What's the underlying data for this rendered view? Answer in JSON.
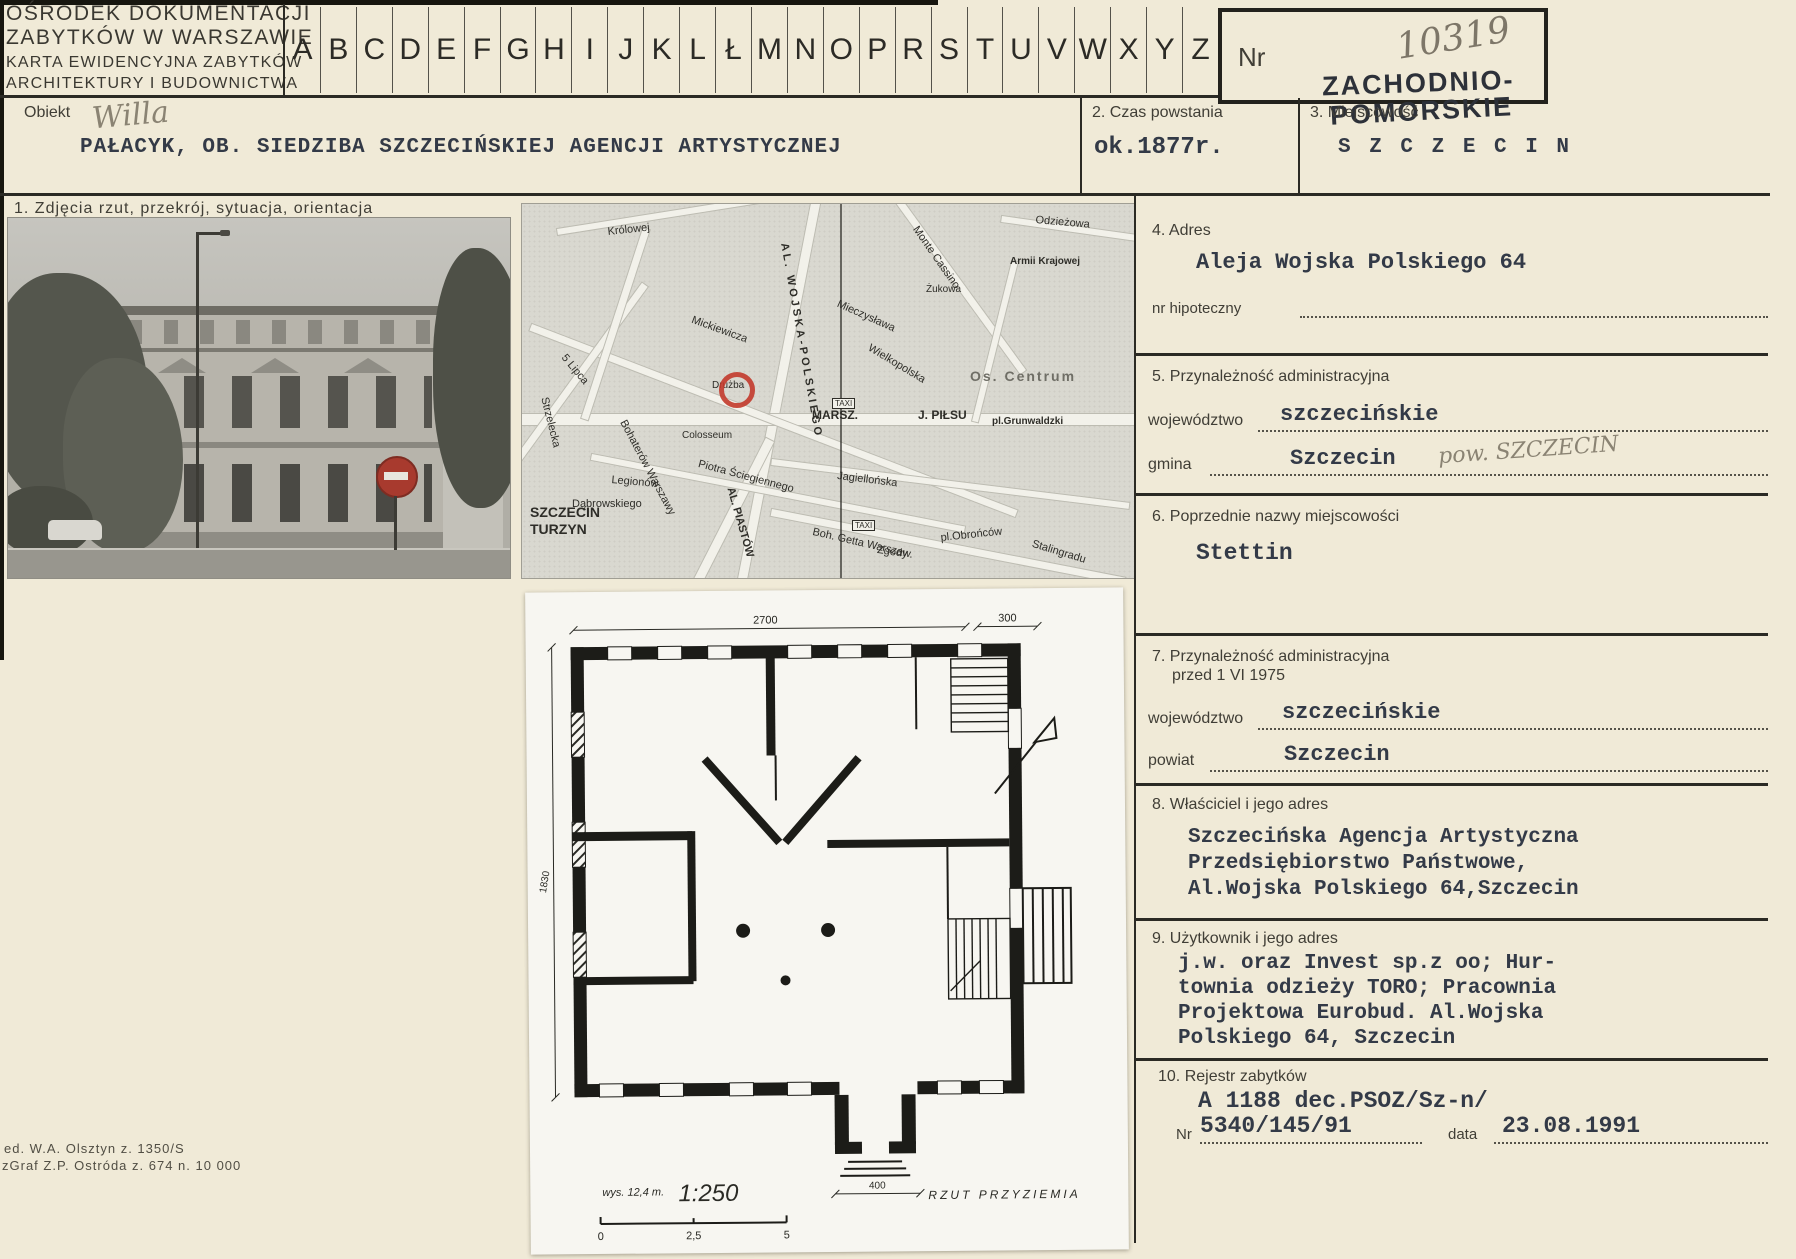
{
  "header": {
    "institution_line1": "OŚRODEK DOKUMENTACJI",
    "institution_line2": "ZABYTKÓW W WARSZAWIE",
    "card_line1": "KARTA EWIDENCYJNA ZABYTKÓW",
    "card_line2": "ARCHITEKTURY I BUDOWNICTWA",
    "alphabet": [
      "A",
      "B",
      "C",
      "D",
      "E",
      "F",
      "G",
      "H",
      "I",
      "J",
      "K",
      "L",
      "Ł",
      "M",
      "N",
      "O",
      "P",
      "R",
      "S",
      "T",
      "U",
      "V",
      "W",
      "X",
      "Y",
      "Z"
    ],
    "nr_label": "Nr",
    "nr_value": "10319",
    "stamp_line1": "ZACHODNIO-",
    "stamp_line2": "POMORSKIE"
  },
  "object_row": {
    "obiekt_label": "Obiekt",
    "handwritten": "Willa",
    "title": "PAŁACYK, OB. SIEDZIBA SZCZECIŃSKIEJ AGENCJI ARTYSTYCZNEJ",
    "czas_label": "2. Czas powstania",
    "czas_value": "ok.1877r.",
    "miejscowosc_label": "3. Miejscowość",
    "miejscowosc_value": "S Z C Z E C I N"
  },
  "photos_caption": "1. Zdjęcia  rzut, przekrój, sytuacja, orientacja",
  "map": {
    "labels": [
      "Królowej",
      "AL. WOJSKA-POLSKIEGO",
      "Monte Cassino",
      "Armii Krajowej",
      "Mickiewicza",
      "5 Lipca",
      "Strzelecka",
      "Jagiellońska",
      "Bohaterów Warszawy",
      "Wielkopolska",
      "Mieczysława",
      "Os. Centrum",
      "MARSZ.",
      "J. PIŁSU",
      "pl.Grunwaldzki",
      "Drużba",
      "Colosseum",
      "SZCZECIN",
      "TURZYN",
      "AL. PIASTÓW",
      "Legionów",
      "Dąbrowskiego",
      "Piotra Ściegiennego",
      "Boh. Getta Warszaw.",
      "Zgody",
      "pl.Obrońców",
      "Stalingradu",
      "Odzieżowa",
      "Żukowa",
      "TAXI",
      "TAXI"
    ]
  },
  "plan": {
    "dim_top": "2700",
    "dim_top_right": "300",
    "dim_left": "1830",
    "dim_porch": "400",
    "height_note": "wys. 12,4 m.",
    "scale": "1:250",
    "bar": [
      "0",
      "2,5",
      "5"
    ],
    "caption": "RZUT  PRZYZIEMIA"
  },
  "s4": {
    "label": "4. Adres",
    "value": "Aleja Wojska Polskiego 64",
    "sub_label": "nr hipoteczny"
  },
  "s5": {
    "label": "5. Przynależność administracyjna",
    "woj_label": "województwo",
    "woj_value": "szczecińskie",
    "gmina_label": "gmina",
    "gmina_value": "Szczecin",
    "gmina_hand": "pow. SZCZECIN"
  },
  "s6": {
    "label": "6. Poprzednie nazwy miejscowości",
    "value": "Stettin"
  },
  "s7": {
    "label_line1": "7. Przynależność administracyjna",
    "label_line2": "przed 1 VI 1975",
    "woj_label": "województwo",
    "woj_value": "szczecińskie",
    "powiat_label": "powiat",
    "powiat_value": "Szczecin"
  },
  "s8": {
    "label": "8. Właściciel i jego adres",
    "line1": "Szczecińska Agencja Artystyczna",
    "line2": "Przedsiębiorstwo Państwowe,",
    "line3": "Al.Wojska Polskiego 64,Szczecin"
  },
  "s9": {
    "label": "9. Użytkownik i jego adres",
    "line1": "j.w. oraz Invest sp.z oo; Hur-",
    "line2": "townia odzieży TORO; Pracownia",
    "line3": "Projektowa Eurobud. Al.Wojska",
    "line4": "Polskiego 64, Szczecin",
    "line4b": ""
  },
  "s10": {
    "label": "10. Rejestr zabytków",
    "line1": "A 1188 dec.PSOZ/Sz-n/",
    "nr_label": "Nr",
    "nr_value": "5340/145/91",
    "data_label": "data",
    "data_value": "23.08.1991"
  },
  "footer": {
    "line1": "ed. W.A. Olsztyn z. 1350/S",
    "line2": "zGraf Z.P. Ostróda z. 674 n. 10 000"
  }
}
